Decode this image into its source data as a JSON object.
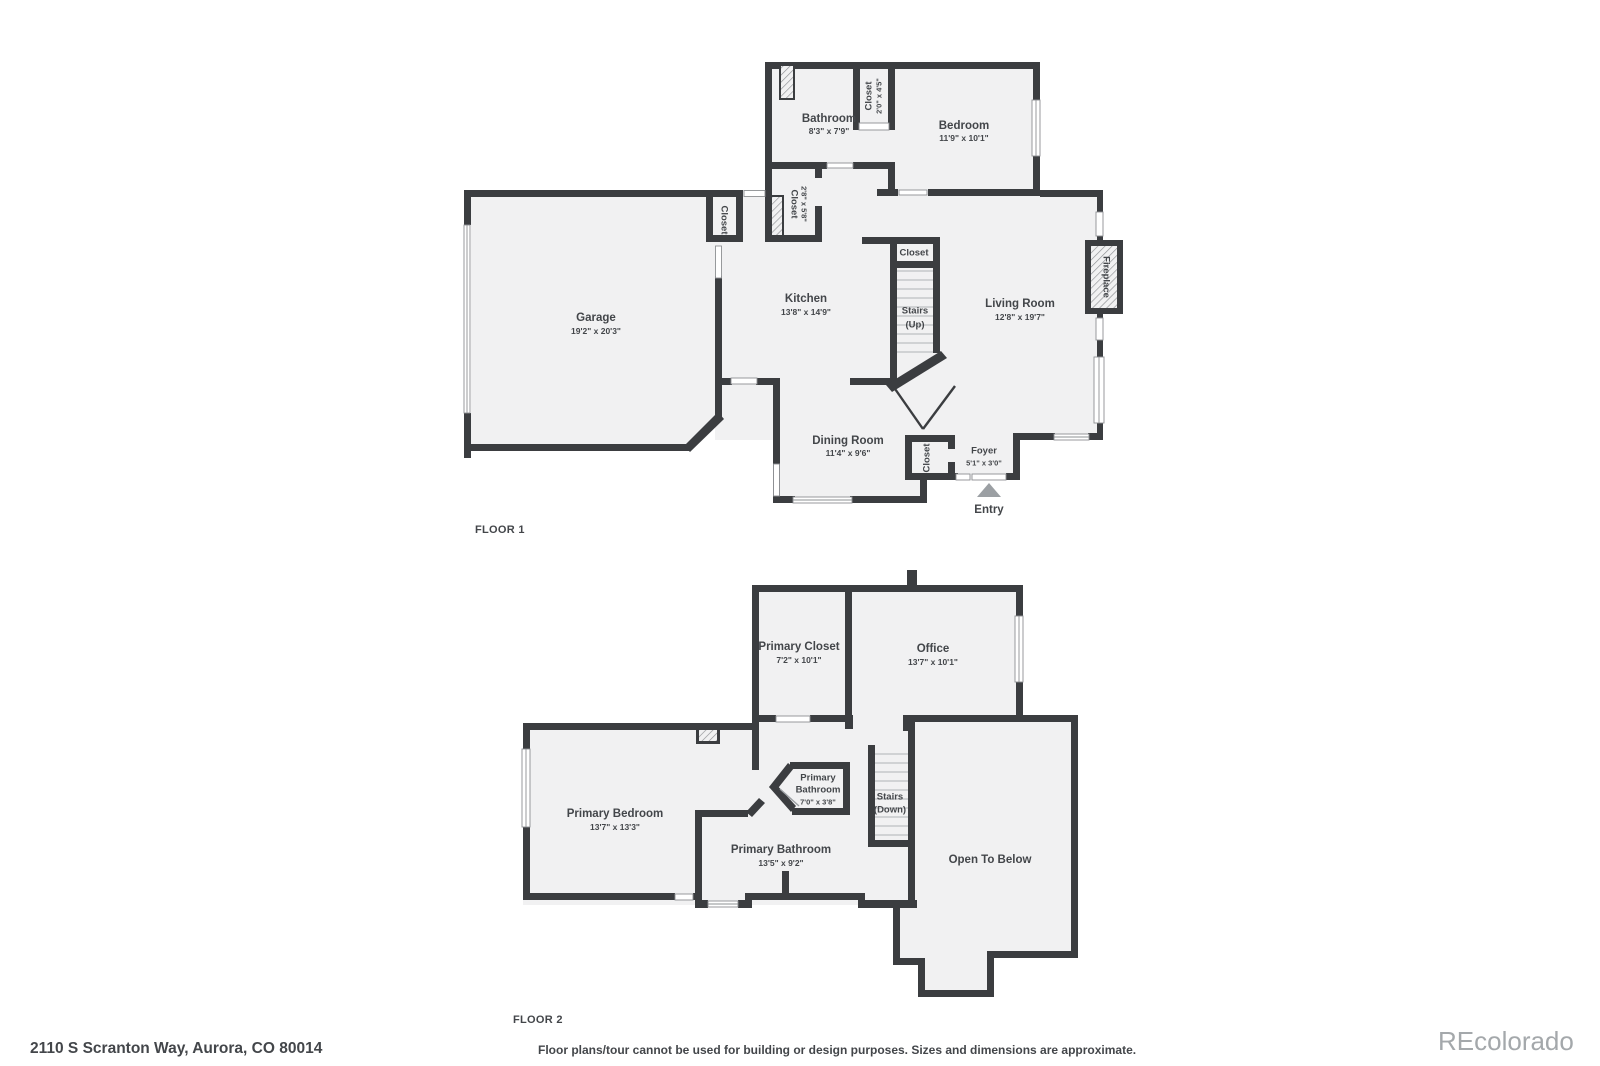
{
  "palette": {
    "wall": "#3b3d40",
    "room": "#f1f1f2",
    "text": "#43464a",
    "muted": "#a4a8ab"
  },
  "floor1": {
    "label": "FLOOR 1",
    "rooms": {
      "garage": {
        "name": "Garage",
        "dims": "19'2\" x 20'3\""
      },
      "kitchen": {
        "name": "Kitchen",
        "dims": "13'8\" x 14'9\""
      },
      "living": {
        "name": "Living Room",
        "dims": "12'8\" x 19'7\""
      },
      "dining": {
        "name": "Dining Room",
        "dims": "11'4\" x 9'6\""
      },
      "bathroom": {
        "name": "Bathroom",
        "dims": "8'3\" x 7'9\""
      },
      "bedroom": {
        "name": "Bedroom",
        "dims": "11'9\" x 10'1\""
      },
      "foyer": {
        "name": "Foyer",
        "dims": "5'1\" x 3'0\""
      },
      "closet_bath": {
        "name": "Closet",
        "dims": "2'0\" x 4'5\""
      },
      "closet_hall": {
        "name": "Closet",
        "dims": "2'8\" x 5'8\""
      },
      "closet_garage": {
        "name": "Closet"
      },
      "closet_stairs": {
        "name": "Closet"
      },
      "closet_foyer": {
        "name": "Closet"
      },
      "stairs": {
        "line1": "Stairs",
        "line2": "(Up)"
      },
      "fireplace": {
        "name": "Fireplace"
      },
      "entry": {
        "name": "Entry"
      }
    }
  },
  "floor2": {
    "label": "FLOOR 2",
    "rooms": {
      "primary_closet": {
        "name": "Primary Closet",
        "dims": "7'2\" x 10'1\""
      },
      "office": {
        "name": "Office",
        "dims": "13'7\" x 10'1\""
      },
      "primary_bedroom": {
        "name": "Primary Bedroom",
        "dims": "13'7\" x 13'3\""
      },
      "primary_bathroom_small": {
        "line1": "Primary",
        "line2": "Bathroom",
        "dims": "7'0\" x 3'8\""
      },
      "primary_bathroom": {
        "name": "Primary Bathroom",
        "dims": "13'5\" x 9'2\""
      },
      "stairs": {
        "line1": "Stairs",
        "line2": "(Down)"
      },
      "open_to_below": {
        "name": "Open To Below"
      }
    }
  },
  "footer": {
    "address": "2110 S Scranton Way, Aurora, CO 80014",
    "disclaimer": "Floor plans/tour cannot be used for building or design purposes. Sizes and dimensions are approximate.",
    "watermark": "REcolorado"
  }
}
